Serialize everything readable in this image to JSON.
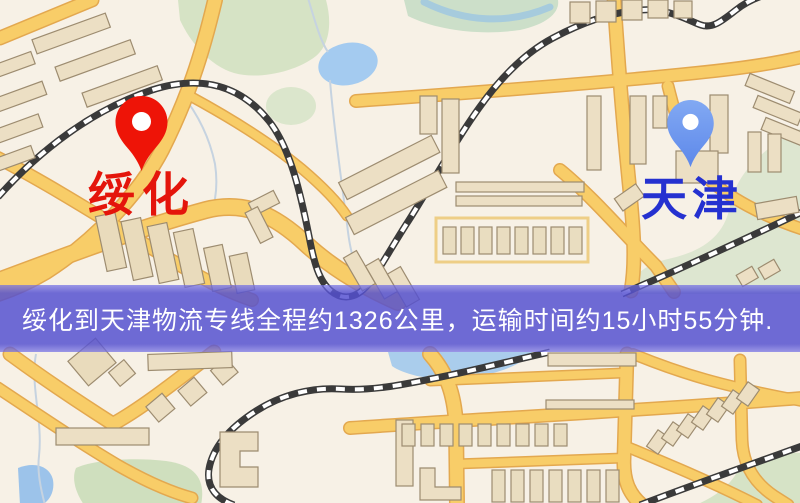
{
  "window": {
    "width": 800,
    "height": 503
  },
  "map": {
    "kind": "street-map",
    "colors": {
      "background": "#f7f1e6",
      "road_fill": "#f8cd68",
      "road_casing": "#e3a84f",
      "building_fill": "#ecdfc4",
      "park_green": "#d6e3c5",
      "water_blue": "#a4cbf0",
      "railway_dark": "#3a3a3a"
    }
  },
  "origin_marker": {
    "label": "绥化",
    "pin_color": "#ee1407",
    "label_color": "#e4150b",
    "icon": "map-pin"
  },
  "destination_marker": {
    "label": "天津",
    "pin_color": "#5d88ea",
    "label_color": "#2531d0",
    "icon": "map-pin"
  },
  "banner": {
    "text": "绥化到天津物流专线全程约1326公里，运输时间约15小时55分钟.",
    "background": "#5450d0",
    "text_color": "#ffffff",
    "route": {
      "origin": "绥化",
      "destination": "天津",
      "distance": "约1326公里",
      "duration": "约15小时55分钟"
    }
  }
}
